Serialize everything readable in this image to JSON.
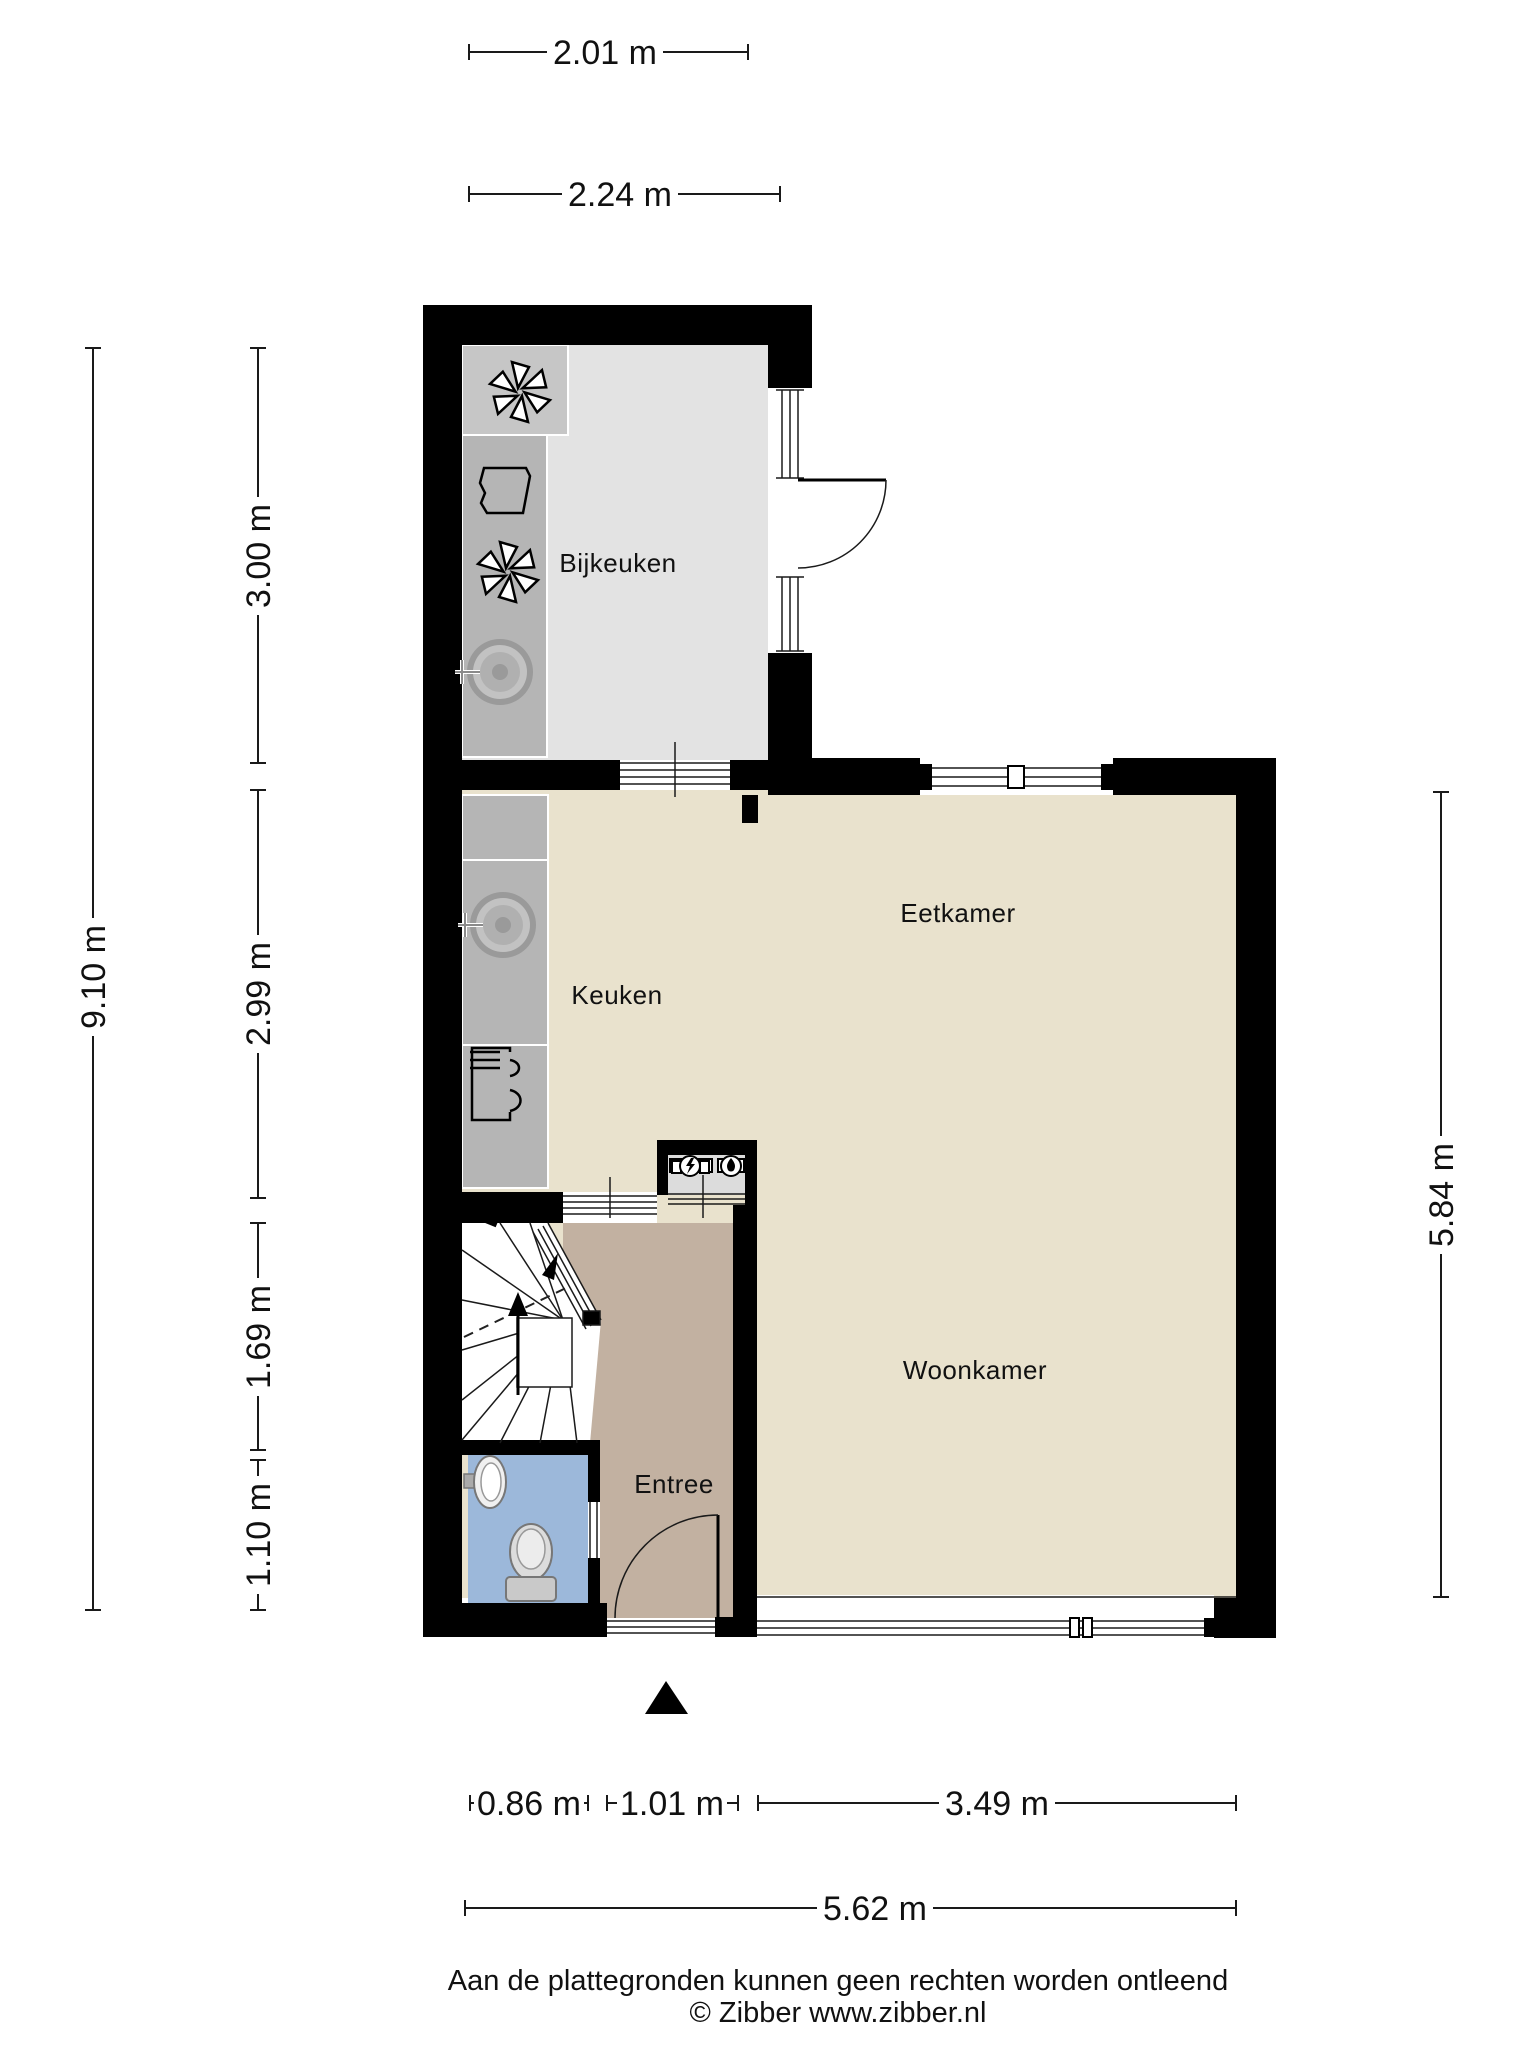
{
  "plan": {
    "type": "floorplan-ground-floor",
    "rooms": {
      "bijkeuken": {
        "label": "Bijkeuken",
        "floor_color": "#e3e3e3"
      },
      "keuken": {
        "label": "Keuken",
        "floor_color": "#e9e2cd"
      },
      "eetkamer": {
        "label": "Eetkamer",
        "floor_color": "#e9e2cd"
      },
      "woonkamer": {
        "label": "Woonkamer",
        "floor_color": "#e9e2cd"
      },
      "entree": {
        "label": "Entree",
        "floor_color": "#c2b1a1"
      },
      "toilet": {
        "floor_color": "#9cb8da"
      },
      "meterkast": {
        "floor_color": "#dcdcdc"
      }
    },
    "colors": {
      "wall": "#000000",
      "counter": "#b5b5b5",
      "appliance_block": "#c6c6c6",
      "stairs": "#ffffff",
      "dimension_line": "#1a1a1a"
    },
    "icons": [
      "washing-machine-fan-icon",
      "laundry-basket-icon",
      "dryer-fan-icon",
      "sink-icon",
      "stove-icon",
      "electric-meter-icon",
      "gas-meter-icon",
      "washbasin-icon",
      "toilet-icon",
      "stairs-up-arrow-icon",
      "entrance-arrow-icon"
    ]
  },
  "dimensions": {
    "top": [
      "2.01 m",
      "2.24 m"
    ],
    "left_total": "9.10 m",
    "left": [
      "3.00 m",
      "2.99 m",
      "1.69 m",
      "1.10 m"
    ],
    "right": "5.84 m",
    "bottom": [
      "0.86 m",
      "1.01 m",
      "3.49 m"
    ],
    "bottom_total": "5.62 m"
  },
  "footer": {
    "disclaimer": "Aan de plattegronden kunnen geen rechten worden ontleend",
    "copyright": "© Zibber www.zibber.nl"
  }
}
